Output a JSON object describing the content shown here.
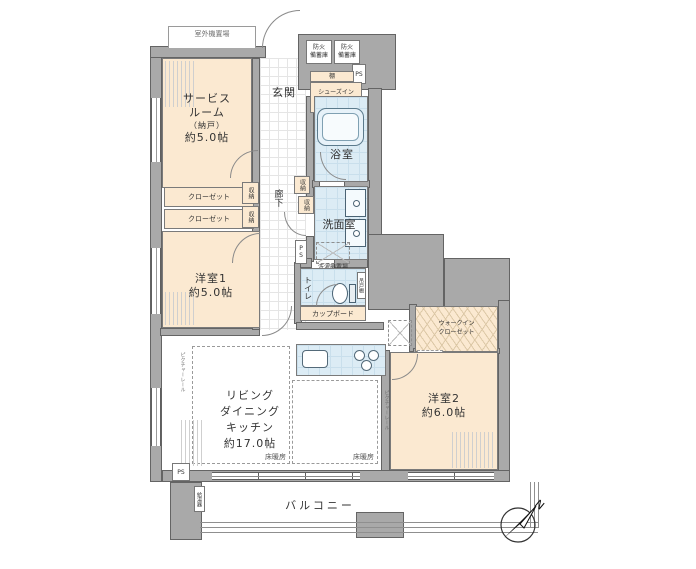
{
  "rooms": {
    "service_room": {
      "l1": "サービス",
      "l2": "ルーム",
      "l3": "（納戸）",
      "l4": "約5.0帖"
    },
    "entrance": {
      "label": "玄関"
    },
    "hallway": {
      "label": "廊下"
    },
    "bath": {
      "label": "浴室"
    },
    "washroom": {
      "label": "洗面室"
    },
    "toilet": {
      "label": "トイレ"
    },
    "bedroom1": {
      "l1": "洋室1",
      "l2": "約5.0帖"
    },
    "bedroom2": {
      "l1": "洋室2",
      "l2": "約6.0帖"
    },
    "ldk": {
      "l1": "リビング",
      "l2": "ダイニング",
      "l3": "キッチン",
      "l4": "約17.0帖"
    },
    "wic": {
      "l1": "ウォークイン",
      "l2": "クローゼット"
    },
    "sic": {
      "l1": "シューズイン",
      "l2": "クローゼット"
    },
    "balcony": {
      "label": "バルコニー"
    }
  },
  "fixtures": {
    "outdoor_unit": "室外機置場",
    "fire_storage_l1": "防火",
    "fire_storage_l2": "備蓄庫",
    "shelf": "棚",
    "ps": "PS",
    "closet": "クローゼット",
    "storage": "収納",
    "laundry": "洗濯機置場",
    "cupboard": "カップボード",
    "floor_heating": "床暖房",
    "picture_rail": "ピクチャーレール",
    "water_heater": "給湯器",
    "hanging_cabinet": "吊戸棚",
    "compass_north": "N"
  },
  "colors": {
    "wall": "#a9a9a9",
    "cream": "#fbe9d1",
    "wet_blue": "#dcecf5",
    "line": "#646464"
  }
}
